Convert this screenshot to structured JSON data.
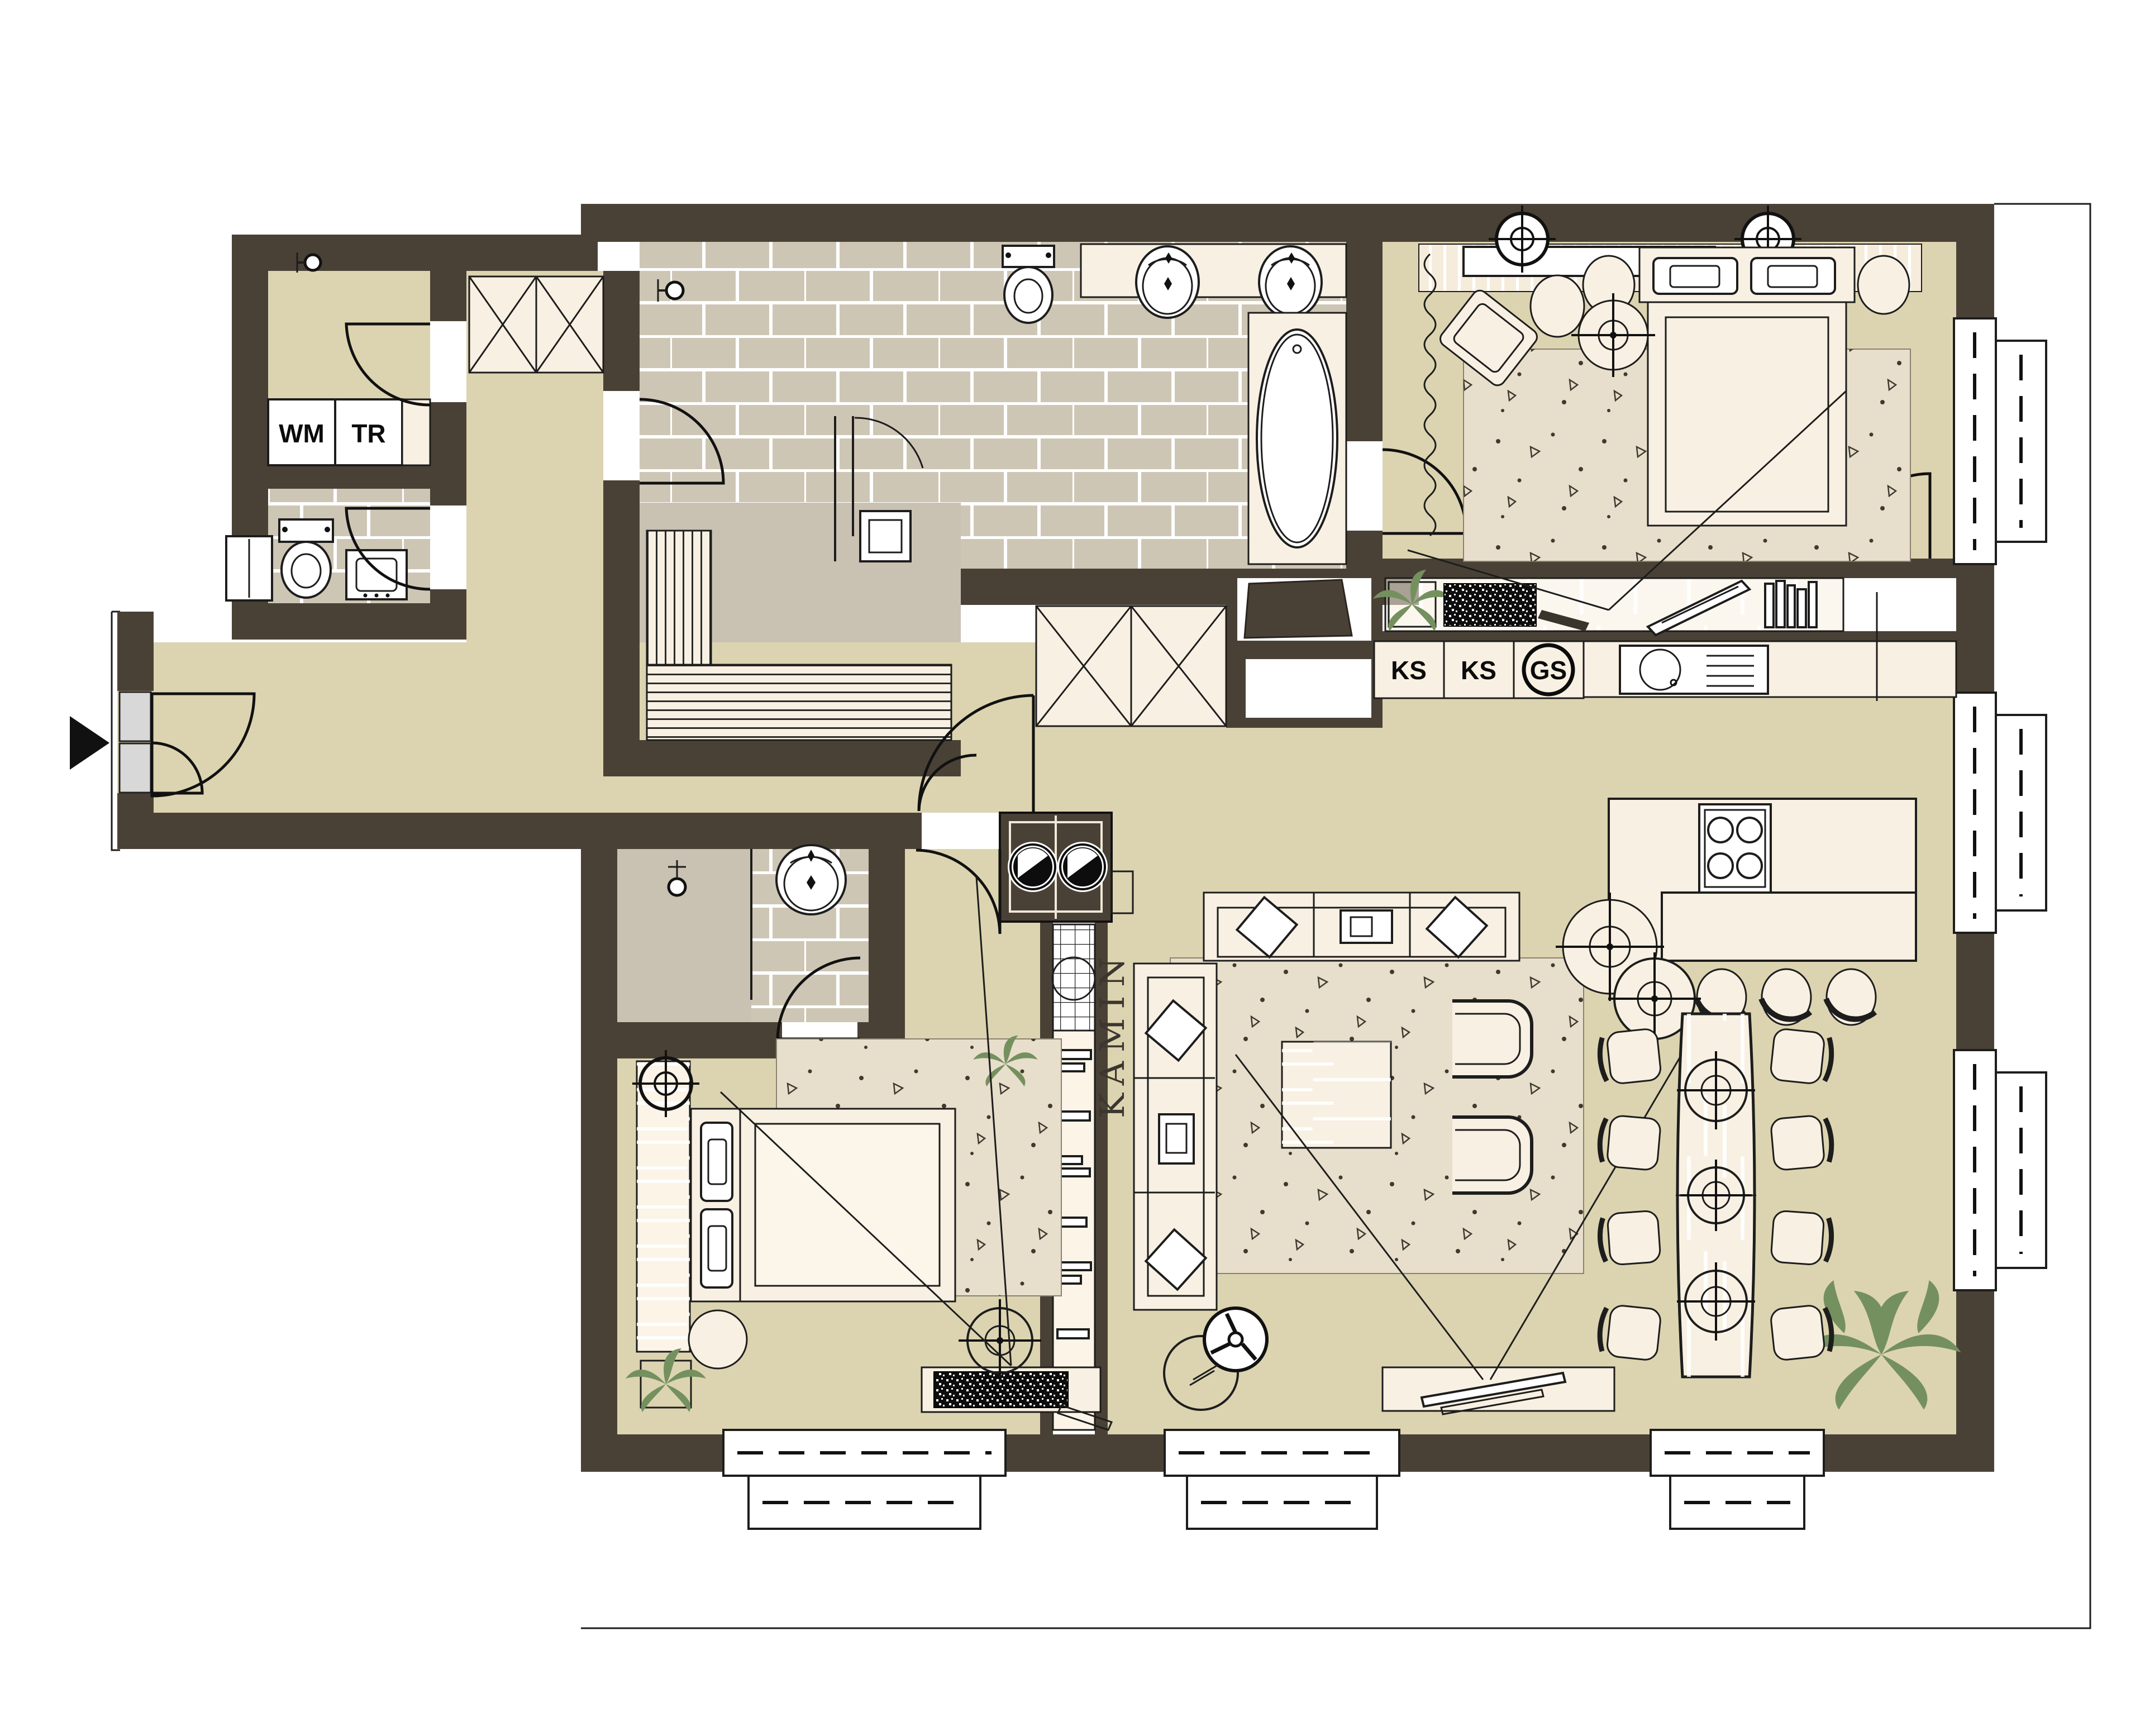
{
  "document": {
    "type": "apartment-floor-plan",
    "style": "architectural top view"
  },
  "labels": {
    "washing_machine": "WM",
    "dryer": "TR",
    "fridge_1": "KS",
    "fridge_2": "KS",
    "dishwasher": "GS",
    "fireplace": "KAMIN"
  },
  "colors": {
    "wall": "#4a4136",
    "floor": "#dcd4b0",
    "tile": "#cec6b5",
    "tile_grout": "#ffffff",
    "shower_floor": "#c9c1b2",
    "furniture": "#f8f0e2",
    "wood": "#f5ecdc",
    "rug": "#e7decb",
    "outline": "#1d1d1d",
    "plant": "#75905f",
    "door_panel": "#d8d8d8"
  }
}
